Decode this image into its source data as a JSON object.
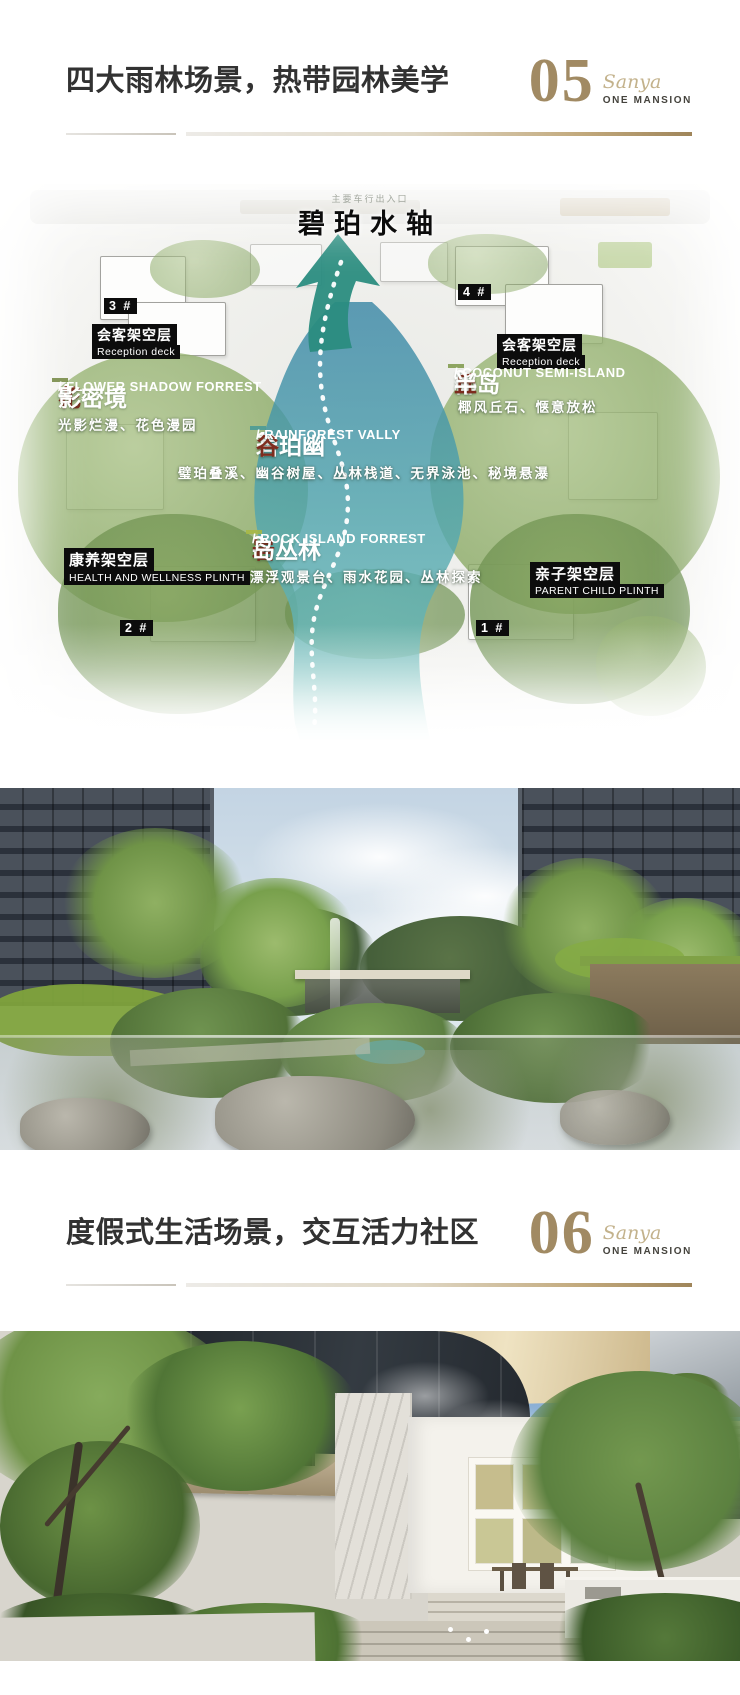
{
  "colors": {
    "accent_gold": "#a18a63",
    "brand_script_gold": "#c3b28c",
    "title_dark": "#323232",
    "zone_accent_red": "#7e2c1e",
    "zone1_band_teal": "#3e9698",
    "zone2_band_yellowgreen": "#a8b840",
    "zone3_band_green": "#76923e",
    "zone4_band_olive": "#698034",
    "water_teal": "#4fa3ad",
    "arrow_green": "#2a8c80"
  },
  "section_05": {
    "number": "05",
    "title": "四大雨林场景，热带园林美学",
    "brand_script": "Sanya",
    "brand_wordmark": "ONE MANSION"
  },
  "master_plan": {
    "axis_title": "碧珀水轴",
    "entrance_note": "主要车行出入口",
    "buildings": [
      "3 #",
      "4 #",
      "2 #",
      "1 #"
    ],
    "reception": {
      "zh": "会客架空层",
      "en": "Reception deck"
    },
    "zones": [
      {
        "num": "1.",
        "pre": "碧珀幽",
        "accent": "谷",
        "post": "",
        "en": "/ RAINFOREST VALLY",
        "features": "璧珀叠溪、幽谷树屋、丛林栈道、无界泳池、秘境悬瀑"
      },
      {
        "num": "2.",
        "pre": "",
        "accent": "岩",
        "post": "岛丛林",
        "en": "/ ROCK ISLAND FORREST",
        "features": "漂浮观景台、雨水花园、丛林探索"
      },
      {
        "num": "3.",
        "pre": "椰",
        "accent": "丘",
        "post": "半岛",
        "en": "/ COCONUT SEMI-ISLAND",
        "features": "椰风丘石、惬意放松"
      },
      {
        "num": "4.",
        "pre": "",
        "accent": "花",
        "post": "影密境",
        "en": "/ FLOWER SHADOW FORREST",
        "features": "光影烂漫、花色漫园"
      }
    ],
    "plinths": [
      {
        "zh": "康养架空层",
        "en": "HEALTH AND WELLNESS PLINTH"
      },
      {
        "zh": "亲子架空层",
        "en": "PARENT CHILD PLINTH"
      }
    ]
  },
  "section_06": {
    "number": "06",
    "title": "度假式生活场景，交互活力社区",
    "brand_script": "Sanya",
    "brand_wordmark": "ONE MANSION"
  }
}
